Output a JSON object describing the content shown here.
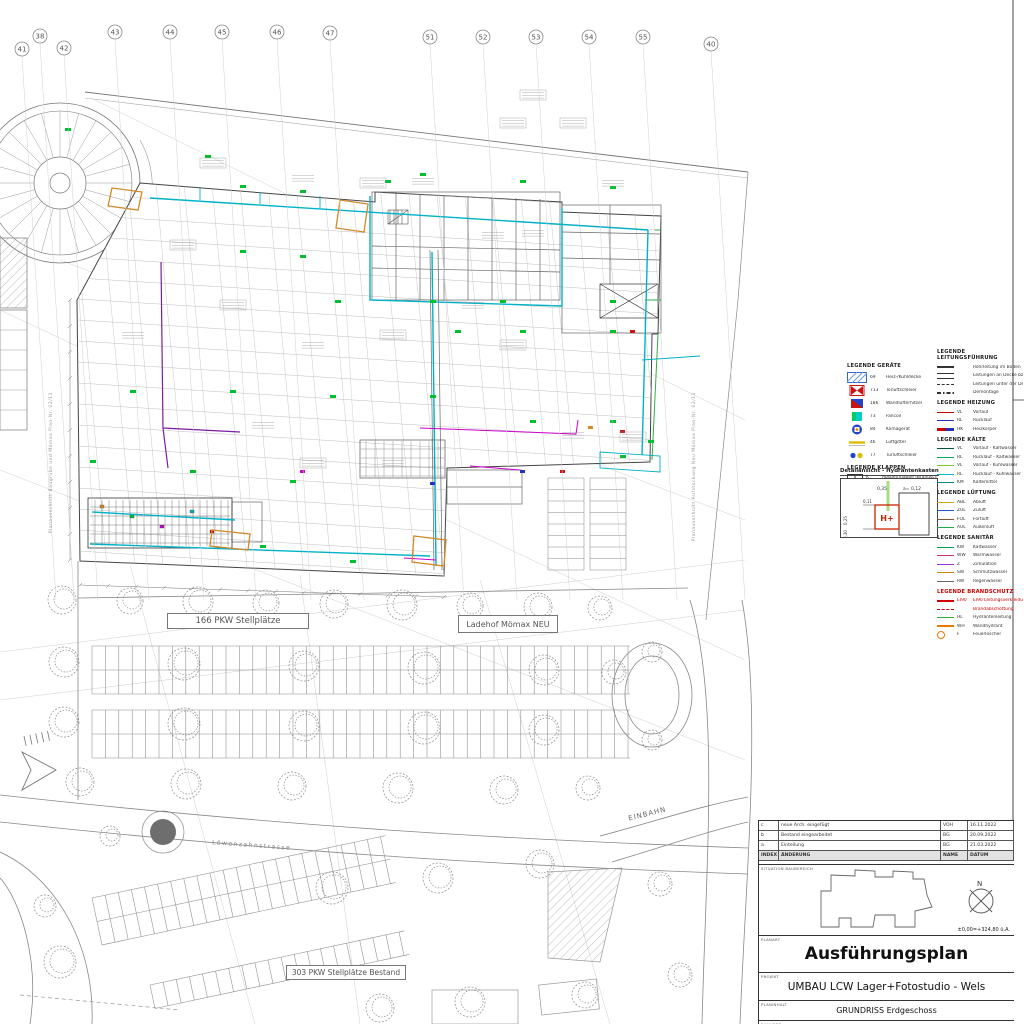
{
  "colors": {
    "cyan_duct": "#00b2c8",
    "green_mark": "#00c030",
    "magenta": "#cc00cc",
    "purple": "#7a1fa0",
    "orange": "#d4882a",
    "red": "#cc1111",
    "grid": "#b8b8b8",
    "line": "#555555"
  },
  "top_grid": {
    "bubbles": [
      {
        "label": "41",
        "x": 22,
        "y": 49
      },
      {
        "label": "38",
        "x": 40,
        "y": 36
      },
      {
        "label": "42",
        "x": 64,
        "y": 48
      },
      {
        "label": "43",
        "x": 115,
        "y": 32
      },
      {
        "label": "44",
        "x": 170,
        "y": 32
      },
      {
        "label": "45",
        "x": 222,
        "y": 32
      },
      {
        "label": "46",
        "x": 277,
        "y": 32
      },
      {
        "label": "47",
        "x": 330,
        "y": 33
      },
      {
        "label": "51",
        "x": 430,
        "y": 37
      },
      {
        "label": "52",
        "x": 483,
        "y": 37
      },
      {
        "label": "53",
        "x": 536,
        "y": 37
      },
      {
        "label": "54",
        "x": 589,
        "y": 37
      },
      {
        "label": "55",
        "x": 643,
        "y": 37
      },
      {
        "label": "40",
        "x": 711,
        "y": 44
      }
    ]
  },
  "plan_labels": {
    "stellplaetze_neu": "166 PKW Stellplätze",
    "ladehof": "Ladehof Mömax NEU",
    "stellplaetze_bestand": "303 PKW Stellplätze Bestand",
    "einbahn": "EINBAHN",
    "strasse": "Löwenzahnstrasse",
    "ausschnitt_left": "Planausschnitt Baugrube und Mömax Plan-Nr. 02/11",
    "ausschnitt_right": "Planausschnitt Aufstockung Neu Mömax Plan-Nr. 02/11"
  },
  "legend_geraete": {
    "title": "LEGENDE GERÄTE",
    "items": [
      {
        "code": "69",
        "label": "Heiz-/Kühldecke",
        "sw": "hatch-blue"
      },
      {
        "code": "713",
        "label": "Torluftschleier",
        "sw": "bowtie-red"
      },
      {
        "code": "186",
        "label": "Wandlufterhitzer",
        "sw": "flag-blue"
      },
      {
        "code": "73",
        "label": "Fancoil",
        "sw": "sq-cyan"
      },
      {
        "code": "84",
        "label": "Klimagerät",
        "sw": "circ-blue"
      },
      {
        "code": "46",
        "label": "Luftgitter",
        "sw": "dash-yellow"
      },
      {
        "code": "77",
        "label": "Türluftschleier",
        "sw": "dots"
      }
    ]
  },
  "legend_klappen": {
    "title": "LEGENDE KLAPPEN",
    "items": [
      {
        "code": "K",
        "label": "Absperrklappe (Brandschutz)",
        "color": "#333333",
        "red": false
      },
      {
        "code": "BSK",
        "label": "Brandschutzklappe",
        "color": "#cc0000",
        "red": true
      },
      {
        "code": "BRSK",
        "label": "Brandrauchschutzklappe",
        "color": "#cc0000",
        "red": true
      }
    ]
  },
  "detail_box": {
    "title": "Detailansicht - Hydrantenkasten",
    "symbol": "H+",
    "d1": "0,35",
    "d2": "a= 0,12",
    "d3": "0,11",
    "d4": "0,25",
    "d5": "0,30"
  },
  "legend_leitung": {
    "title": "LEGENDE LEITUNGSFÜHRUNG",
    "items": [
      {
        "code": "",
        "label": "Rohrleitung im Boden",
        "color": "#333333",
        "style": "solid-thick"
      },
      {
        "code": "",
        "label": "Leitungen an Decke bzw. frei verlegt",
        "color": "#333333",
        "style": "double"
      },
      {
        "code": "",
        "label": "Leitungen unter der Decke",
        "color": "#333333",
        "style": "dashed"
      },
      {
        "code": "",
        "label": "Demontage",
        "color": "#333333",
        "style": "dashdot"
      }
    ]
  },
  "legend_heizung": {
    "title": "LEGENDE HEIZUNG",
    "items": [
      {
        "code": "VL",
        "label": "Vorlauf",
        "color": "#cc0000",
        "style": "solid"
      },
      {
        "code": "RL",
        "label": "Rücklauf",
        "color": "#2233bb",
        "style": "solid"
      },
      {
        "code": "HK",
        "label": "Heizkörper",
        "color": "#cc0000",
        "style": "multi"
      }
    ]
  },
  "legend_kaelte": {
    "title": "LEGENDE KÄLTE",
    "items": [
      {
        "code": "VL",
        "label": "Vorlauf - Kaltwasser",
        "color": "#005533",
        "style": "solid"
      },
      {
        "code": "RL",
        "label": "Rücklauf - Kaltwasser",
        "color": "#00aa55",
        "style": "solid"
      },
      {
        "code": "VL",
        "label": "Vorlauf - Kühlwasser",
        "color": "#77cc33",
        "style": "solid"
      },
      {
        "code": "RL",
        "label": "Rücklauf - Kühlwasser",
        "color": "#00bbcc",
        "style": "solid"
      },
      {
        "code": "KM",
        "label": "Kältemittel",
        "color": "#008888",
        "style": "solid"
      }
    ]
  },
  "legend_lueftung": {
    "title": "LEGENDE LÜFTUNG",
    "items": [
      {
        "code": "ABL",
        "label": "Abluft",
        "color": "#ccaa00",
        "style": "solid"
      },
      {
        "code": "ZUL",
        "label": "Zuluft",
        "color": "#2255cc",
        "style": "solid"
      },
      {
        "code": "FOL",
        "label": "Fortluft",
        "color": "#885533",
        "style": "solid"
      },
      {
        "code": "AUL",
        "label": "Außenluft",
        "color": "#22aa44",
        "style": "solid"
      }
    ]
  },
  "legend_sanitaer": {
    "title": "LEGENDE SANITÄR",
    "items": [
      {
        "code": "KW",
        "label": "Kaltwasser",
        "color": "#00a050",
        "style": "solid"
      },
      {
        "code": "WW",
        "label": "Warmwasser",
        "color": "#cc3366",
        "style": "solid"
      },
      {
        "code": "Z",
        "label": "Zirkulation",
        "color": "#9933cc",
        "style": "solid"
      },
      {
        "code": "SW",
        "label": "Schmutzwasser",
        "color": "#cc8800",
        "style": "solid"
      },
      {
        "code": "RW",
        "label": "Regenwasser",
        "color": "#666666",
        "style": "solid"
      }
    ]
  },
  "legend_brandschutz": {
    "title": "LEGENDE BRANDSCHUTZ",
    "items": [
      {
        "code": "EI90",
        "label": "EI90 Leitungsverkleidung",
        "color": "#cc0000",
        "style": "solid-thick",
        "red": true
      },
      {
        "code": "",
        "label": "Brandabschottung",
        "color": "#cc0000",
        "style": "dashed",
        "red": true
      },
      {
        "code": "HL",
        "label": "Hydrantenleitung",
        "color": "#33aa33",
        "style": "solid",
        "red": false
      },
      {
        "code": "WH",
        "label": "Wandhydrant",
        "color": "#ee7700",
        "style": "solid-thick",
        "red": false
      },
      {
        "code": "F",
        "label": "Feuerlöscher",
        "color": "#ee7700",
        "style": "symbol",
        "red": false
      }
    ]
  },
  "titleblock": {
    "planart_label": "PLANART",
    "planart": "Ausführungsplan",
    "projekt_label": "PROJEKT",
    "projekt": "UMBAU LCW Lager+Fotostudio - Wels",
    "planinhalt_label": "PLANINHALT",
    "planinhalt": "GRUNDRISS Erdgeschoss",
    "bauherr_label": "BAUHERR",
    "bauherr_line1": "Sar Leasing GmbH,",
    "bauherr_line2": "A-4600 Wels, Römerstraße 39",
    "keyplan_label": "SITUATION BAUBEREICH",
    "elevation": "±0,00=+324,80 ü.A.",
    "north_letter": "N"
  },
  "revisions": {
    "header": {
      "idx": "INDEX",
      "text": "ÄNDERUNG",
      "name": "NAME",
      "date": "DATUM"
    },
    "rows": [
      {
        "idx": "c",
        "text": "neue Arch. eingefügt",
        "name": "VOH",
        "date": "16.11.2022"
      },
      {
        "idx": "b",
        "text": "Bestand eingearbeitet",
        "name": "BG",
        "date": "20.09.2022"
      },
      {
        "idx": "a",
        "text": "Einteilung",
        "name": "BG",
        "date": "21.03.2022"
      }
    ]
  }
}
